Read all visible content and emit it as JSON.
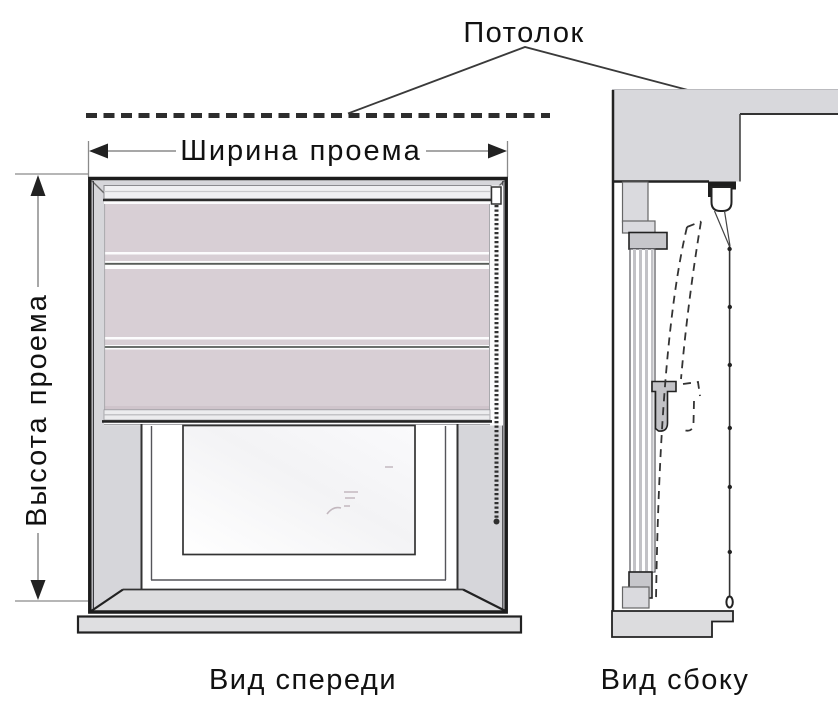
{
  "figure": {
    "type": "blind-measurement-diagram",
    "labels": {
      "ceiling": "Потолок",
      "opening_width": "Ширина проема",
      "opening_height": "Высота проема",
      "front_view_caption": "Вид спереди",
      "side_view_caption": "Вид сбоку"
    },
    "colors": {
      "background": "#ffffff",
      "wall_gray": "#d6d6da",
      "fabric_mauve": "#d8cfd5",
      "rail_light": "#efeff1",
      "outline_dark": "#1c1c1c",
      "dimension_gray": "#8a8a8a",
      "dash_black": "#2d2d2d"
    }
  }
}
